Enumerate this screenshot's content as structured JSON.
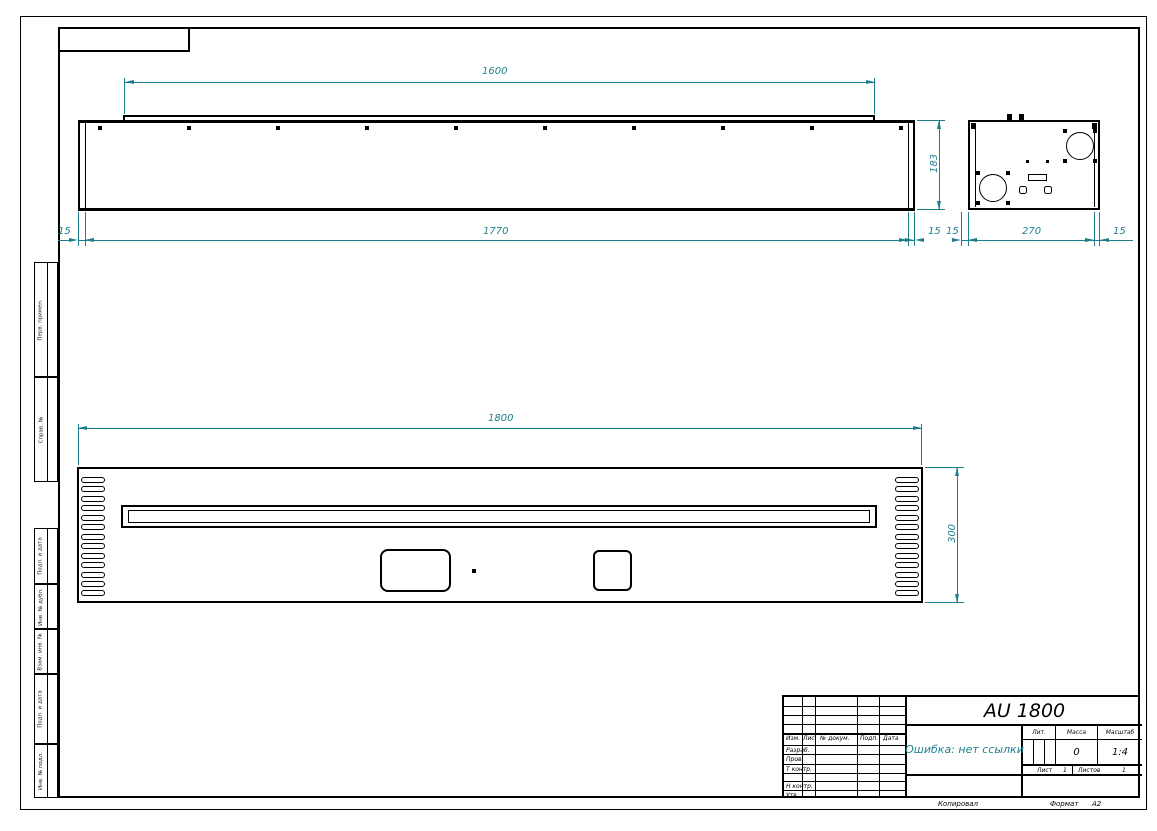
{
  "drawing": {
    "title": "AU 1800",
    "error_note": "Ошибка: нет ссылки",
    "accent_color": "#1b7f8c",
    "dims": {
      "top_flange_width": "1600",
      "top_overall_width": "1770",
      "top_left_offset": "15",
      "top_view_height": "183",
      "side_wall_left": "15",
      "side_wall_gap": "15",
      "side_width": "270",
      "side_wall_right": "15",
      "front_width": "1800",
      "front_height": "300"
    }
  },
  "title_block": {
    "header_cols": [
      "Изм.",
      "Лист",
      "№ докум.",
      "Подп.",
      "Дата"
    ],
    "row_labels": [
      "Разраб.",
      "Пров.",
      "Т контр.",
      "Н контр.",
      "Утв."
    ],
    "lit_label": "Лит.",
    "mass_label": "Масса",
    "scale_label": "Масштаб",
    "mass_value": "0",
    "scale_value": "1:4",
    "sheet_label": "Лист",
    "sheet_value": "1",
    "sheets_label": "Листов",
    "sheets_value": "1",
    "copied_label": "Копировал",
    "format_label": "Формат",
    "format_value": "А2"
  },
  "margin_labels": {
    "perv_primen": "Перв. примен.",
    "sprav_no": "Справ. №",
    "podp_data_1": "Подп. и дата",
    "inv_dubl": "Инв. № дубл.",
    "vzam_inv": "Взам. инв. №",
    "podp_data_2": "Подп. и дата",
    "inv_podl": "Инв. № подл."
  }
}
